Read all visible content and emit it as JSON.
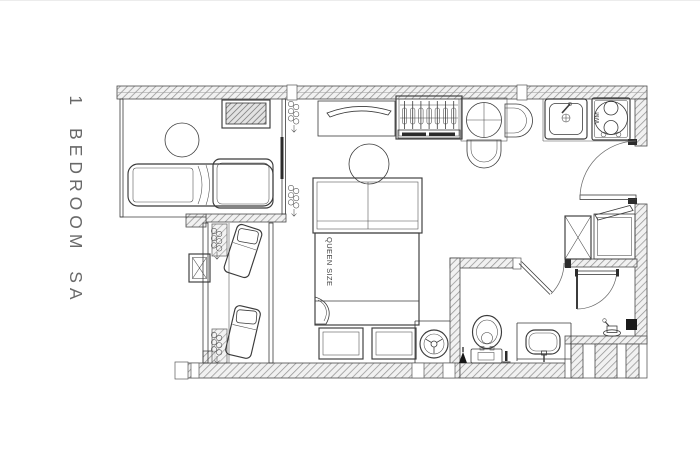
{
  "plan": {
    "title": "1 BEDROOM SA",
    "bed_label": "QUEEN SIZE",
    "appliance_label": "WM"
  },
  "colors": {
    "line": "#3b3b3b",
    "wall_hatch": "#949494",
    "wall_fill": "#f1f1f1",
    "background": "#ffffff",
    "label_text": "#696969"
  },
  "fixtures": [
    "sofa",
    "coffee-table",
    "tv-console",
    "sliding-partition",
    "curtain",
    "curtain",
    "air-conditioner",
    "lounge-chair",
    "lounge-chair",
    "balcony-railing",
    "queen-bed",
    "pendant-light",
    "headboard-shelf",
    "foot-bench",
    "foot-bench",
    "washing-machine",
    "wardrobe",
    "dining-table",
    "dining-chair",
    "dining-chair",
    "kitchen-sink",
    "cooktop",
    "refrigerator",
    "kitchen-cabinet",
    "entry-door",
    "bathroom-door",
    "shower-door",
    "toilet",
    "vanity-basin",
    "shower-mixer",
    "floor-drain",
    "towel-rail"
  ]
}
